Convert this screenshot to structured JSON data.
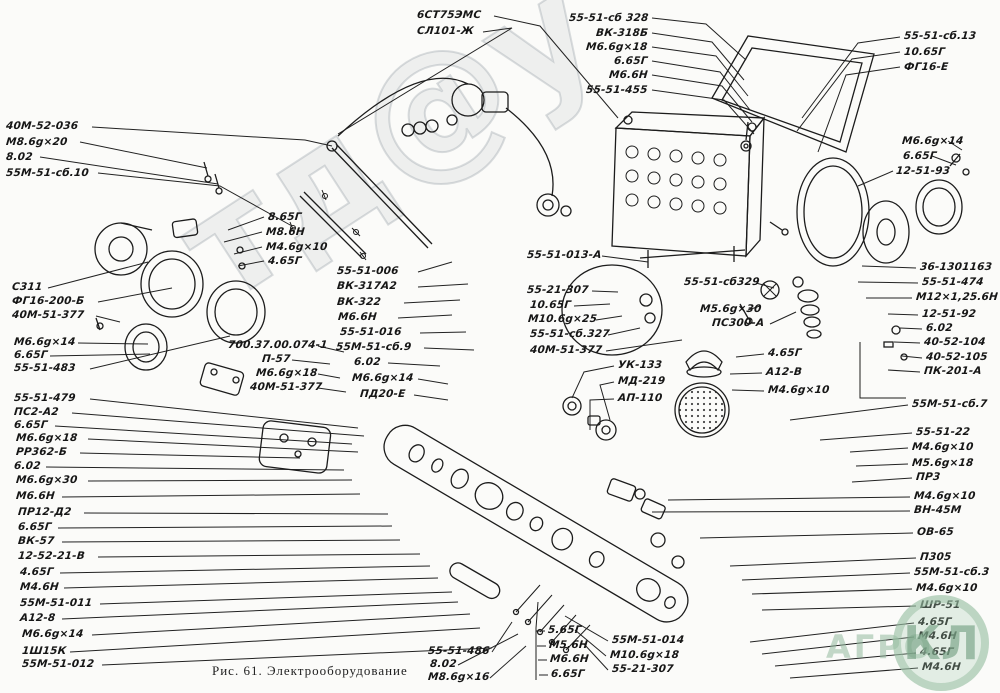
{
  "figure": {
    "caption": "Рис. 61. Электрооборудование"
  },
  "watermark": {
    "diagonal": "тд@у",
    "agro": "АГРО",
    "badge": "КЛ"
  },
  "labels": [
    {
      "t": "6СТ75ЭМС",
      "x": 417,
      "y": 9,
      "lead": [
        494,
        16,
        540,
        26,
        618,
        118
      ]
    },
    {
      "t": "СЛ101-Ж",
      "x": 417,
      "y": 25,
      "lead": [
        483,
        32,
        512,
        28,
        338,
        134
      ]
    },
    {
      "t": "55-51-сб 328",
      "x": 648,
      "y": 12,
      "a": "r",
      "lead": [
        652,
        18,
        706,
        24,
        746,
        60
      ]
    },
    {
      "t": "ВК-318Б",
      "x": 648,
      "y": 27,
      "a": "r",
      "lead": [
        652,
        33,
        712,
        42,
        744,
        80
      ]
    },
    {
      "t": "М6.6g×18",
      "x": 648,
      "y": 41,
      "a": "r",
      "lead": [
        652,
        47,
        716,
        56,
        748,
        96
      ]
    },
    {
      "t": "6.65Г",
      "x": 648,
      "y": 55,
      "a": "r",
      "lead": [
        652,
        61,
        720,
        72,
        750,
        110
      ]
    },
    {
      "t": "М6.6Н",
      "x": 648,
      "y": 69,
      "a": "r",
      "lead": [
        652,
        75,
        722,
        86,
        752,
        122
      ]
    },
    {
      "t": "55-51-455",
      "x": 648,
      "y": 84,
      "a": "r",
      "lead": [
        652,
        90,
        724,
        100,
        754,
        134
      ]
    },
    {
      "t": "55-51-сб.13",
      "x": 904,
      "y": 30,
      "lead": [
        900,
        37,
        858,
        43,
        802,
        118
      ]
    },
    {
      "t": "10.65Г",
      "x": 904,
      "y": 46,
      "lead": [
        900,
        52,
        852,
        59,
        797,
        131
      ]
    },
    {
      "t": "ФГ16-Е",
      "x": 904,
      "y": 61,
      "lead": [
        900,
        67,
        846,
        75,
        818,
        152
      ]
    },
    {
      "t": "М6.6g×14",
      "x": 902,
      "y": 135,
      "lead": [
        948,
        141,
        962,
        150
      ]
    },
    {
      "t": "6.65Г",
      "x": 903,
      "y": 150,
      "lead": [
        932,
        156,
        956,
        165
      ]
    },
    {
      "t": "12-51-93",
      "x": 896,
      "y": 165,
      "lead": [
        893,
        171,
        858,
        186
      ]
    },
    {
      "t": "40М-52-036",
      "x": 6,
      "y": 120,
      "lead": [
        92,
        127,
        305,
        140,
        332,
        146
      ]
    },
    {
      "t": "М8.6g×20",
      "x": 6,
      "y": 136,
      "lead": [
        80,
        142,
        207,
        168
      ]
    },
    {
      "t": "8.02",
      "x": 6,
      "y": 151,
      "lead": [
        40,
        157,
        218,
        184
      ]
    },
    {
      "t": "55М-51-сб.10",
      "x": 6,
      "y": 167,
      "lead": [
        98,
        173,
        220,
        186,
        292,
        226
      ]
    },
    {
      "t": "8.65Г",
      "x": 268,
      "y": 211,
      "lead": [
        264,
        217,
        228,
        230
      ]
    },
    {
      "t": "М8.6Н",
      "x": 266,
      "y": 226,
      "lead": [
        262,
        232,
        224,
        242
      ]
    },
    {
      "t": "М4.6g×10",
      "x": 266,
      "y": 241,
      "lead": [
        262,
        247,
        234,
        254
      ]
    },
    {
      "t": "4.65Г",
      "x": 268,
      "y": 255,
      "lead": [
        264,
        261,
        238,
        266
      ]
    },
    {
      "t": "С311",
      "x": 12,
      "y": 281,
      "lead": [
        48,
        288,
        148,
        262
      ]
    },
    {
      "t": "ФГ16-200-Б",
      "x": 12,
      "y": 295,
      "lead": [
        98,
        302,
        172,
        288
      ]
    },
    {
      "t": "40М-51-377",
      "x": 12,
      "y": 309,
      "lead": [
        96,
        316,
        120,
        322
      ]
    },
    {
      "t": "М6.6g×14",
      "x": 14,
      "y": 336,
      "lead": [
        78,
        343,
        148,
        344
      ]
    },
    {
      "t": "6.65Г",
      "x": 14,
      "y": 349,
      "lead": [
        50,
        356,
        150,
        354
      ]
    },
    {
      "t": "55-51-483",
      "x": 14,
      "y": 362,
      "lead": [
        90,
        369,
        230,
        336
      ]
    },
    {
      "t": "55-51-479",
      "x": 14,
      "y": 392,
      "lead": [
        90,
        399,
        358,
        428
      ]
    },
    {
      "t": "ПС2-А2",
      "x": 14,
      "y": 406,
      "lead": [
        72,
        413,
        364,
        436
      ]
    },
    {
      "t": "6.65Г",
      "x": 14,
      "y": 419,
      "lead": [
        55,
        426,
        352,
        444
      ]
    },
    {
      "t": "М6.6g×18",
      "x": 16,
      "y": 432,
      "lead": [
        88,
        439,
        358,
        452
      ]
    },
    {
      "t": "РР362-Б",
      "x": 16,
      "y": 446,
      "lead": [
        80,
        453,
        300,
        458
      ]
    },
    {
      "t": "6.02",
      "x": 14,
      "y": 460,
      "lead": [
        46,
        467,
        344,
        470
      ]
    },
    {
      "t": "М6.6g×30",
      "x": 16,
      "y": 474,
      "lead": [
        88,
        481,
        352,
        480
      ]
    },
    {
      "t": "М6.6Н",
      "x": 16,
      "y": 490,
      "lead": [
        62,
        497,
        360,
        494
      ]
    },
    {
      "t": "ПР12-Д2",
      "x": 18,
      "y": 506,
      "lead": [
        84,
        513,
        388,
        514
      ]
    },
    {
      "t": "6.65Г",
      "x": 18,
      "y": 521,
      "lead": [
        58,
        528,
        392,
        526
      ]
    },
    {
      "t": "ВК-57",
      "x": 18,
      "y": 535,
      "lead": [
        62,
        542,
        400,
        540
      ]
    },
    {
      "t": "12-52-21-В",
      "x": 18,
      "y": 550,
      "lead": [
        98,
        557,
        420,
        554
      ]
    },
    {
      "t": "4.65Г",
      "x": 20,
      "y": 566,
      "lead": [
        60,
        573,
        430,
        566
      ]
    },
    {
      "t": "М4.6Н",
      "x": 20,
      "y": 581,
      "lead": [
        64,
        588,
        438,
        578
      ]
    },
    {
      "t": "55М-51-011",
      "x": 20,
      "y": 597,
      "lead": [
        100,
        604,
        452,
        592
      ]
    },
    {
      "t": "А12-8",
      "x": 20,
      "y": 612,
      "lead": [
        62,
        619,
        458,
        602
      ]
    },
    {
      "t": "М6.6g×14",
      "x": 22,
      "y": 628,
      "lead": [
        92,
        635,
        470,
        614
      ]
    },
    {
      "t": "1Ш15К",
      "x": 22,
      "y": 645,
      "lead": [
        70,
        652,
        480,
        628
      ]
    },
    {
      "t": "55М-51-012",
      "x": 22,
      "y": 658,
      "lead": [
        102,
        665,
        492,
        648
      ]
    },
    {
      "t": "55-51-006",
      "x": 337,
      "y": 265,
      "lead": [
        418,
        272,
        452,
        262
      ]
    },
    {
      "t": "ВК-317А2",
      "x": 337,
      "y": 280,
      "lead": [
        418,
        287,
        468,
        284
      ]
    },
    {
      "t": "ВК-322",
      "x": 337,
      "y": 296,
      "lead": [
        404,
        303,
        460,
        300
      ]
    },
    {
      "t": "М6.6Н",
      "x": 338,
      "y": 311,
      "lead": [
        398,
        318,
        452,
        315
      ]
    },
    {
      "t": "55-51-016",
      "x": 340,
      "y": 326,
      "lead": [
        420,
        333,
        466,
        332
      ]
    },
    {
      "t": "55М-51-сб.9",
      "x": 336,
      "y": 341,
      "lead": [
        424,
        348,
        474,
        350
      ]
    },
    {
      "t": "6.02",
      "x": 354,
      "y": 356,
      "lead": [
        388,
        363,
        440,
        366
      ]
    },
    {
      "t": "М6.6g×14",
      "x": 352,
      "y": 372,
      "lead": [
        418,
        379,
        448,
        384
      ]
    },
    {
      "t": "ПД20-Е",
      "x": 360,
      "y": 388,
      "lead": [
        414,
        395,
        448,
        400
      ]
    },
    {
      "t": "700.37.00.074-1",
      "x": 228,
      "y": 339,
      "lead": [
        318,
        346,
        344,
        352
      ]
    },
    {
      "t": "П-57",
      "x": 262,
      "y": 353,
      "lead": [
        292,
        360,
        330,
        364
      ]
    },
    {
      "t": "М6.6g×18",
      "x": 256,
      "y": 367,
      "lead": [
        318,
        374,
        340,
        378
      ]
    },
    {
      "t": "40М-51-377",
      "x": 250,
      "y": 381,
      "lead": [
        318,
        388,
        346,
        392
      ]
    },
    {
      "t": "55-51-013-А",
      "x": 527,
      "y": 249,
      "lead": [
        602,
        256,
        648,
        262
      ]
    },
    {
      "t": "55-21-307",
      "x": 527,
      "y": 284,
      "lead": [
        592,
        291,
        618,
        292
      ]
    },
    {
      "t": "10.65Г",
      "x": 530,
      "y": 299,
      "lead": [
        574,
        306,
        610,
        304
      ]
    },
    {
      "t": "М10.6g×25",
      "x": 528,
      "y": 313,
      "lead": [
        596,
        320,
        622,
        316
      ]
    },
    {
      "t": "55-51-сб.327",
      "x": 530,
      "y": 328,
      "lead": [
        608,
        335,
        640,
        328
      ]
    },
    {
      "t": "40М-51-377",
      "x": 530,
      "y": 344,
      "lead": [
        606,
        351,
        682,
        340
      ]
    },
    {
      "t": "55-51-сб329",
      "x": 684,
      "y": 276,
      "lead": [
        756,
        283,
        774,
        288
      ]
    },
    {
      "t": "М5.6g×30",
      "x": 700,
      "y": 303,
      "lead": [
        748,
        310,
        760,
        306
      ]
    },
    {
      "t": "ПС300-А",
      "x": 712,
      "y": 317,
      "lead": [
        770,
        324,
        796,
        312
      ]
    },
    {
      "t": "36-1301163",
      "x": 920,
      "y": 261,
      "lead": [
        916,
        268,
        862,
        266
      ]
    },
    {
      "t": "55-51-474",
      "x": 922,
      "y": 276,
      "lead": [
        918,
        283,
        858,
        282
      ]
    },
    {
      "t": "М12×1,25.6Н",
      "x": 916,
      "y": 291,
      "lead": [
        912,
        298,
        866,
        298
      ]
    },
    {
      "t": "12-51-92",
      "x": 922,
      "y": 308,
      "lead": [
        918,
        315,
        888,
        314
      ]
    },
    {
      "t": "6.02",
      "x": 926,
      "y": 322,
      "lead": [
        922,
        329,
        900,
        328
      ]
    },
    {
      "t": "40-52-104",
      "x": 924,
      "y": 336,
      "lead": [
        920,
        343,
        894,
        342
      ]
    },
    {
      "t": "40-52-105",
      "x": 926,
      "y": 351,
      "lead": [
        922,
        358,
        902,
        356
      ]
    },
    {
      "t": "ПК-201-А",
      "x": 924,
      "y": 365,
      "lead": [
        920,
        372,
        888,
        370
      ]
    },
    {
      "t": "4.65Г",
      "x": 768,
      "y": 347,
      "lead": [
        764,
        354,
        736,
        357
      ]
    },
    {
      "t": "А12-В",
      "x": 766,
      "y": 366,
      "lead": [
        762,
        373,
        730,
        374
      ]
    },
    {
      "t": "М4.6g×10",
      "x": 768,
      "y": 384,
      "lead": [
        764,
        391,
        732,
        390
      ]
    },
    {
      "t": "УК-133",
      "x": 618,
      "y": 359,
      "lead": [
        614,
        366,
        584,
        372,
        572,
        398
      ]
    },
    {
      "t": "МД-219",
      "x": 618,
      "y": 375,
      "lead": [
        614,
        382,
        600,
        385,
        610,
        420
      ]
    },
    {
      "t": "АП-110",
      "x": 618,
      "y": 392,
      "lead": [
        614,
        399,
        590,
        400,
        590,
        430
      ]
    },
    {
      "t": "55М-51-сб.7",
      "x": 912,
      "y": 398,
      "lead": [
        908,
        405,
        790,
        420
      ]
    },
    {
      "t": "55-51-22",
      "x": 916,
      "y": 426,
      "lead": [
        912,
        433,
        820,
        440
      ]
    },
    {
      "t": "М4.6g×10",
      "x": 912,
      "y": 441,
      "lead": [
        908,
        448,
        850,
        452
      ]
    },
    {
      "t": "М5.6g×18",
      "x": 912,
      "y": 457,
      "lead": [
        908,
        464,
        856,
        466
      ]
    },
    {
      "t": "ПР3",
      "x": 916,
      "y": 471,
      "lead": [
        912,
        478,
        852,
        482
      ]
    },
    {
      "t": "М4.6g×10",
      "x": 914,
      "y": 490,
      "lead": [
        910,
        497,
        668,
        500
      ]
    },
    {
      "t": "ВН-45М",
      "x": 914,
      "y": 504,
      "lead": [
        910,
        511,
        652,
        512
      ]
    },
    {
      "t": "ОВ-65",
      "x": 917,
      "y": 526,
      "lead": [
        913,
        533,
        700,
        538
      ]
    },
    {
      "t": "П305",
      "x": 920,
      "y": 551,
      "lead": [
        916,
        558,
        730,
        566
      ]
    },
    {
      "t": "55М-51-сб.3",
      "x": 914,
      "y": 566,
      "lead": [
        910,
        573,
        742,
        580
      ]
    },
    {
      "t": "М4.6g×10",
      "x": 916,
      "y": 582,
      "lead": [
        912,
        589,
        752,
        594
      ]
    },
    {
      "t": "ШР-51",
      "x": 920,
      "y": 599,
      "lead": [
        916,
        606,
        762,
        610
      ]
    },
    {
      "t": "4.65Г",
      "x": 918,
      "y": 616,
      "lead": [
        914,
        623,
        750,
        642
      ]
    },
    {
      "t": "М4.6Н",
      "x": 918,
      "y": 630,
      "lead": [
        914,
        637,
        762,
        654
      ]
    },
    {
      "t": "4.65Г",
      "x": 920,
      "y": 646,
      "lead": [
        916,
        653,
        775,
        666
      ]
    },
    {
      "t": "М4.6Н",
      "x": 922,
      "y": 661,
      "lead": [
        918,
        668,
        790,
        678
      ]
    },
    {
      "t": "5.65Г",
      "x": 548,
      "y": 624,
      "lead": [
        545,
        631,
        536,
        631
      ]
    },
    {
      "t": "М5.6Н",
      "x": 549,
      "y": 639,
      "lead": [
        546,
        646,
        537,
        646
      ]
    },
    {
      "t": "М6.6Н",
      "x": 550,
      "y": 653,
      "lead": [
        547,
        660,
        538,
        660
      ]
    },
    {
      "t": "6.65Г",
      "x": 551,
      "y": 668,
      "lead": [
        548,
        675,
        539,
        675
      ]
    },
    {
      "t": "55М-51-014",
      "x": 612,
      "y": 634,
      "lead": [
        608,
        641,
        565,
        616
      ]
    },
    {
      "t": "М10.6g×18",
      "x": 610,
      "y": 649,
      "lead": [
        606,
        656,
        575,
        630
      ]
    },
    {
      "t": "55-21-307",
      "x": 612,
      "y": 663,
      "lead": [
        608,
        670,
        584,
        644
      ]
    },
    {
      "t": "55-51-486",
      "x": 428,
      "y": 645,
      "lead": [
        492,
        652,
        512,
        622
      ]
    },
    {
      "t": "8.02",
      "x": 430,
      "y": 658,
      "lead": [
        458,
        665,
        518,
        634
      ]
    },
    {
      "t": "М8.6g×16",
      "x": 428,
      "y": 671,
      "lead": [
        490,
        678,
        526,
        646
      ]
    }
  ]
}
